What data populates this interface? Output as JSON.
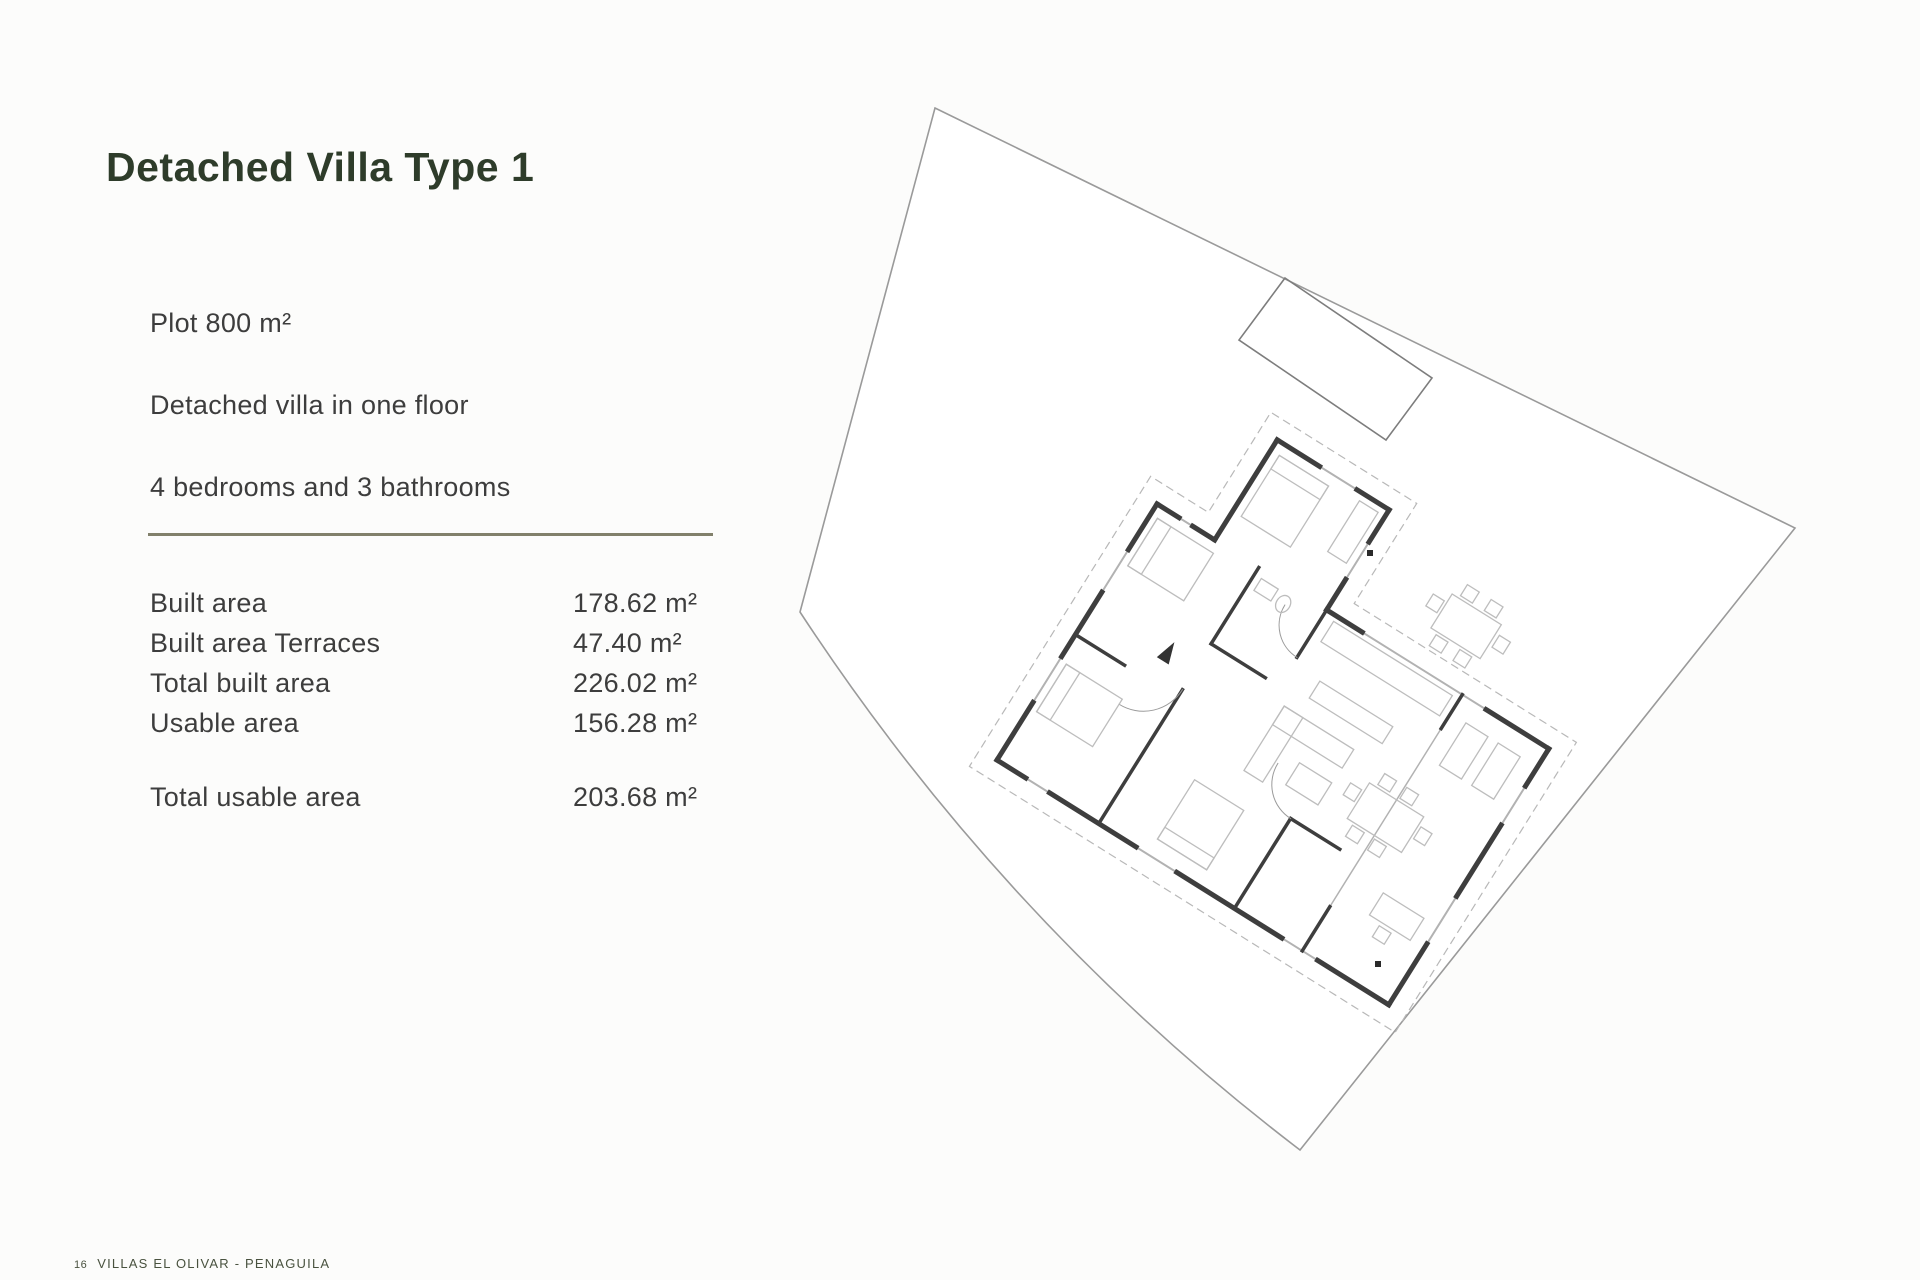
{
  "page": {
    "title": "Detached Villa Type 1",
    "footer_number": "16",
    "footer_text": "VILLAS EL OLIVAR - PENAGUILA"
  },
  "specs": {
    "plot": "Plot 800 m²",
    "floor": "Detached villa in one floor",
    "rooms": "4 bedrooms and 3 bathrooms"
  },
  "areas": {
    "rows": [
      {
        "label": "Built area",
        "value": "178.62 m²"
      },
      {
        "label": "Built area Terraces",
        "value": "47.40 m²"
      },
      {
        "label": "Total built area",
        "value": "226.02 m²"
      },
      {
        "label": "Usable area",
        "value": "156.28 m²"
      }
    ],
    "total": {
      "label": "Total usable area",
      "value": "203.68 m²"
    }
  },
  "colors": {
    "title": "#2e3c2a",
    "body_text": "#3d3d3d",
    "divider": "#81806b",
    "footer": "#49523f",
    "plot_boundary": "#9a9a9a",
    "plan_walls": "#3e3e3e",
    "plan_windows": "#b2b2b2",
    "plan_furniture": "#bdbdbd"
  },
  "plan": {
    "elements": [
      "plot-boundary",
      "swimming-pool",
      "villa-floor-plan",
      "roof-overhang-dashed-line",
      "survey-marker-dots"
    ]
  }
}
